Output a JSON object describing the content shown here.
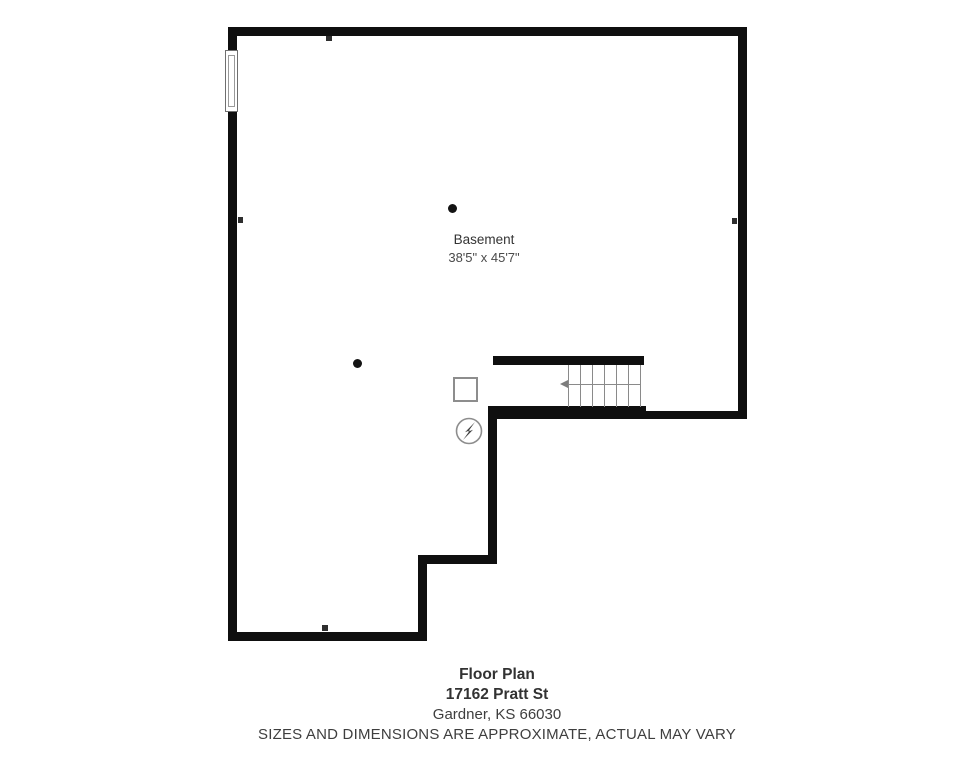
{
  "room": {
    "name": "Basement",
    "dimensions": "38'5\" x 45'7\""
  },
  "footer": {
    "title": "Floor Plan",
    "address_line1": "17162 Pratt St",
    "address_line2": "Gardner, KS 66030",
    "disclaimer": "SIZES AND DIMENSIONS ARE APPROXIMATE, ACTUAL MAY VARY"
  },
  "symbols": {
    "window": "double-pane window on left wall",
    "staircase": "stairs with 7 risers and left-pointing walk-line arrow",
    "support_posts": 2,
    "utility_box": "square outline column/utility",
    "electrical_panel": "circle with lightning bolt",
    "outlet_markers": 4
  },
  "colors": {
    "wall": "#0f0f0f",
    "line": "#8a8a8a",
    "text": "#333333",
    "background": "#ffffff"
  }
}
